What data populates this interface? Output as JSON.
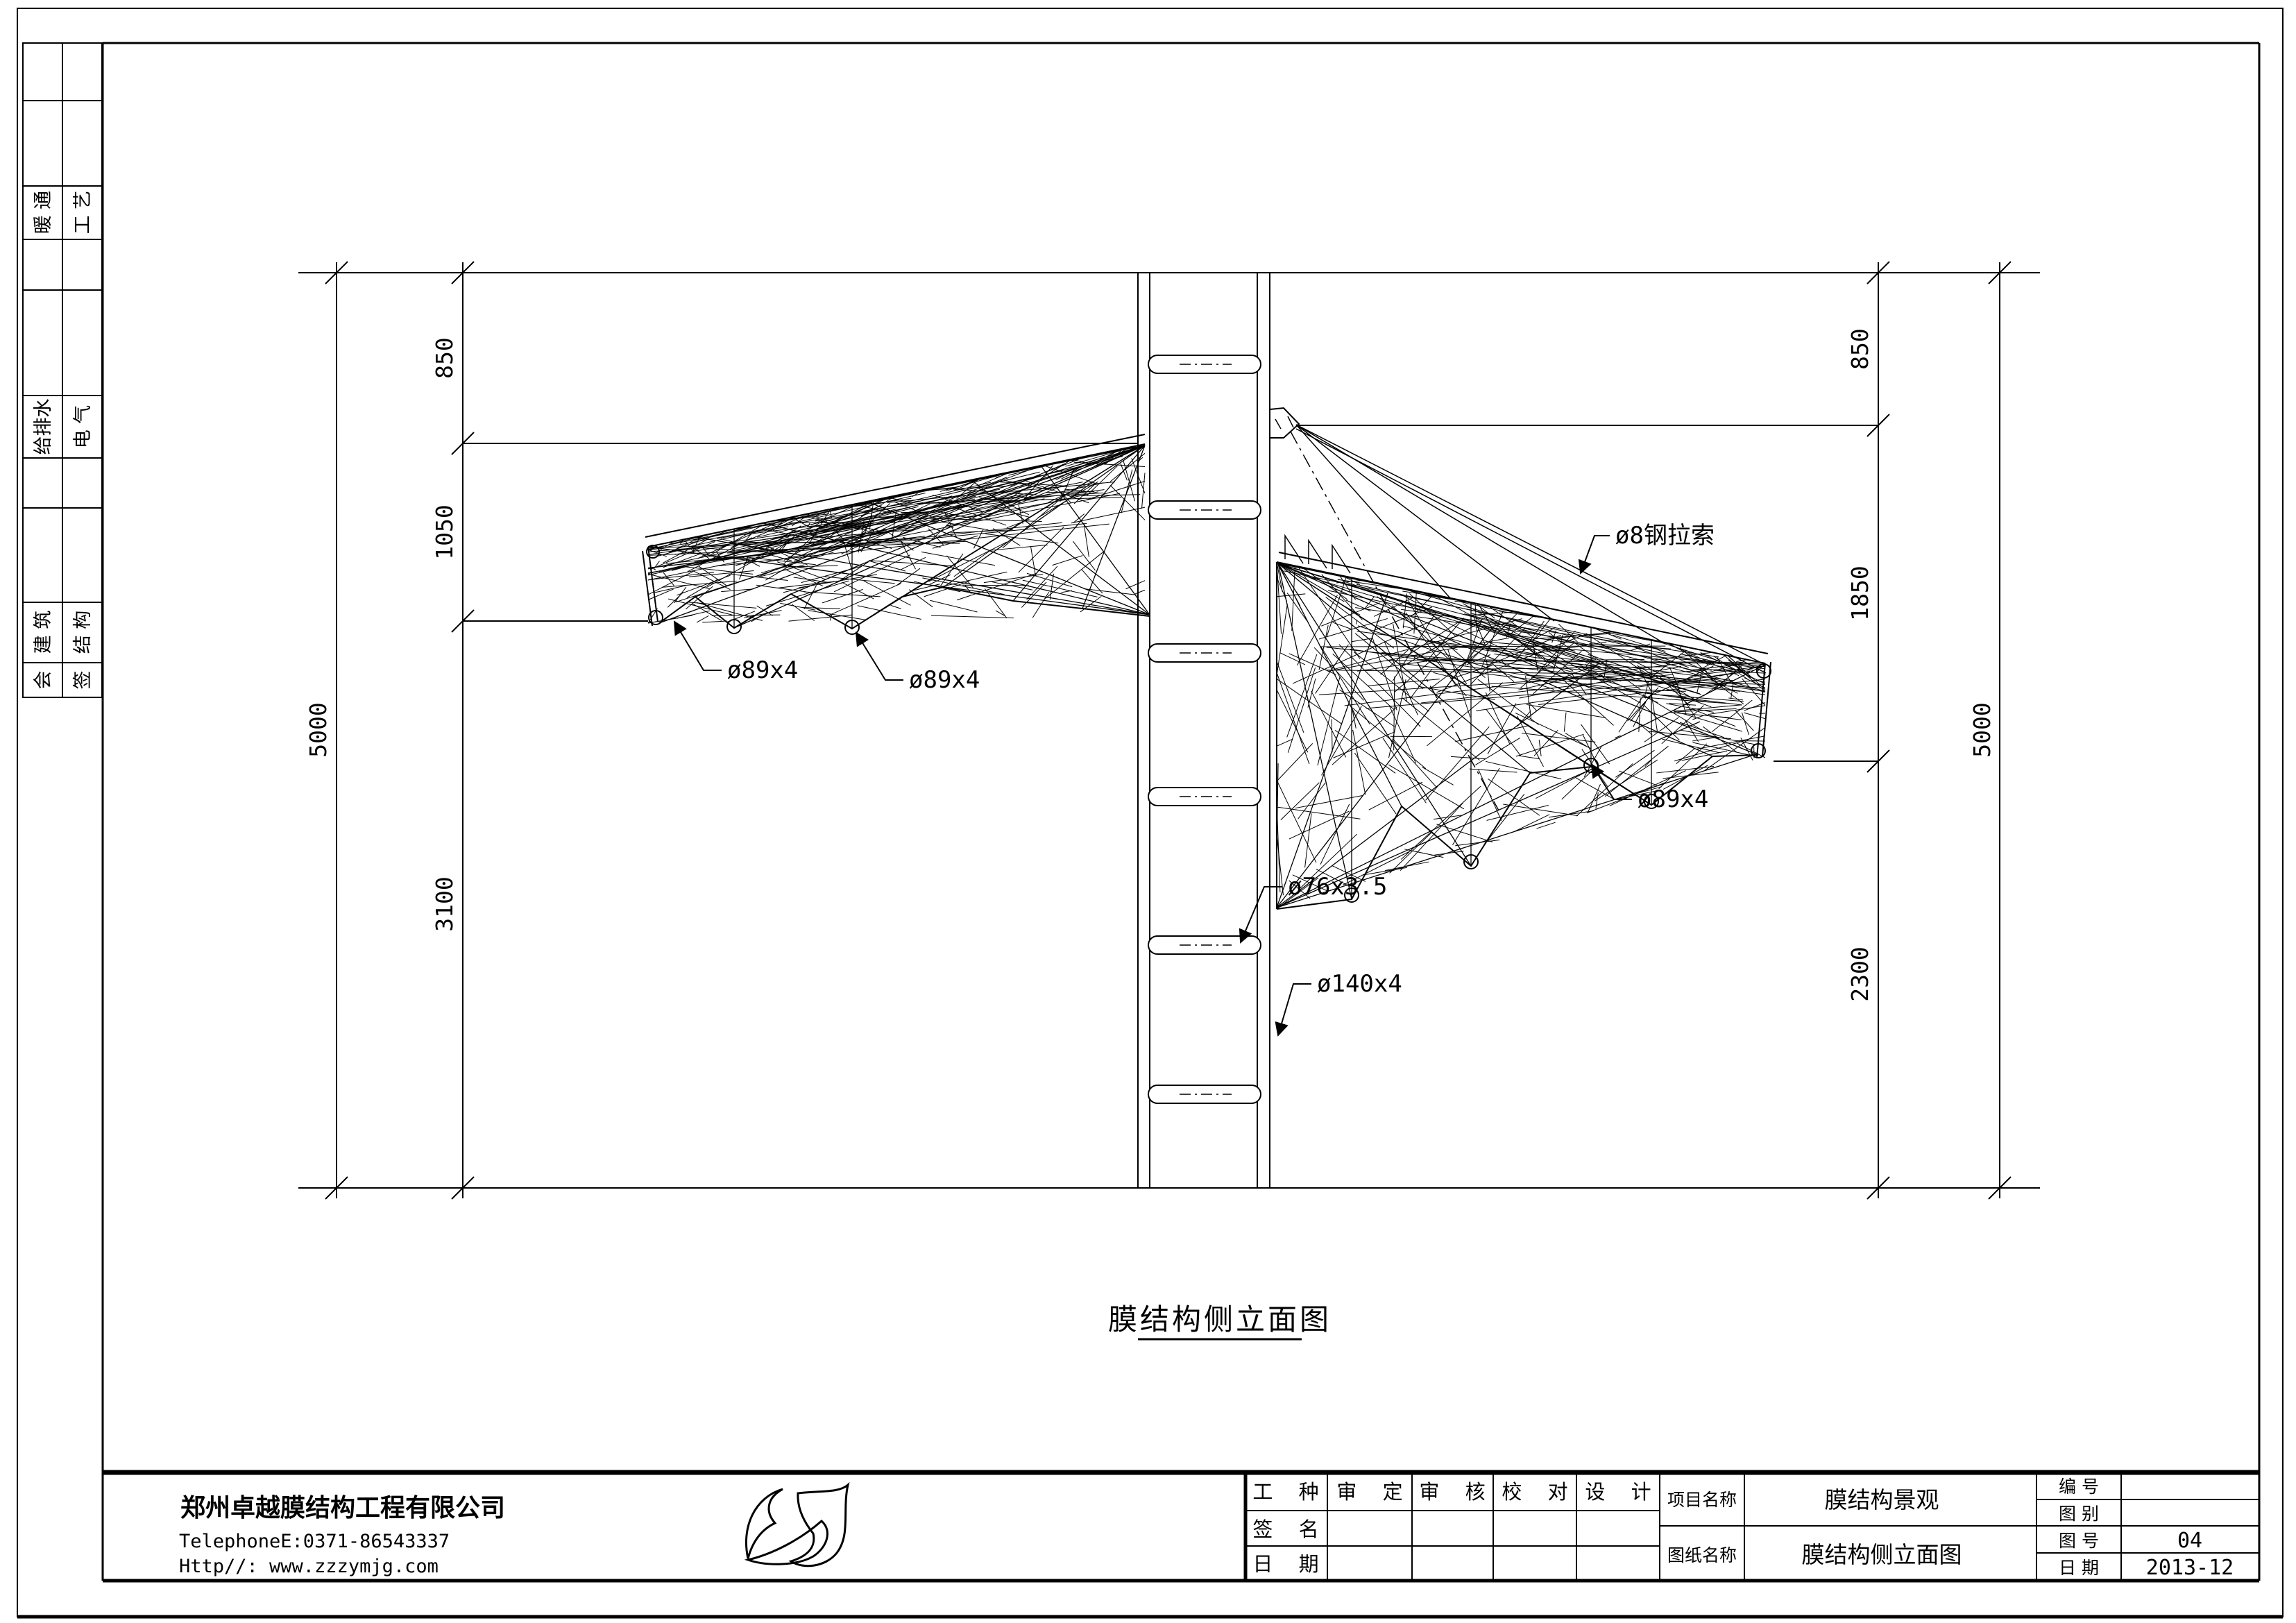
{
  "sheet": {
    "background": "#ffffff",
    "line_color": "#000000"
  },
  "sidebar": {
    "rows": [
      {
        "left": "暖 通",
        "right": "工 艺"
      },
      {
        "left": "给排水",
        "right": "电 气"
      },
      {
        "left": "建 筑",
        "right": "结 构"
      },
      {
        "left": "会",
        "right": "签"
      }
    ]
  },
  "dimensions": {
    "left_outer": "5000",
    "left_segments": [
      "850",
      "1050",
      "3100"
    ],
    "right_outer": "5000",
    "right_segments": [
      "850",
      "1850",
      "2300"
    ]
  },
  "annotations": {
    "pipe_left_1": "ø89x4",
    "pipe_left_2": "ø89x4",
    "cable": "ø8钢拉索",
    "pipe_right": "ø89x4",
    "rung": "ø76x3.5",
    "mast": "ø140x4"
  },
  "drawing_title": "膜结构侧立面图",
  "title_block": {
    "company": {
      "name": "郑州卓越膜结构工程有限公司",
      "phone": "TelephoneE:0371-86543337",
      "website": "Http//: www.zzzymjg.com"
    },
    "approval": {
      "headers": [
        "工 种",
        "审 定",
        "审 核",
        "校 对",
        "设 计"
      ],
      "sign_label": "签 名",
      "date_label": "日 期"
    },
    "project": {
      "label": "项目名称",
      "value": "膜结构景观"
    },
    "drawing": {
      "label": "图纸名称",
      "value": "膜结构侧立面图"
    },
    "meta": {
      "number_label": "编 号",
      "number_value": "",
      "category_label": "图 别",
      "category_value": "",
      "sheet_no_label": "图 号",
      "sheet_no_value": "04",
      "date_label": "日 期",
      "date_value": "2013-12"
    }
  }
}
